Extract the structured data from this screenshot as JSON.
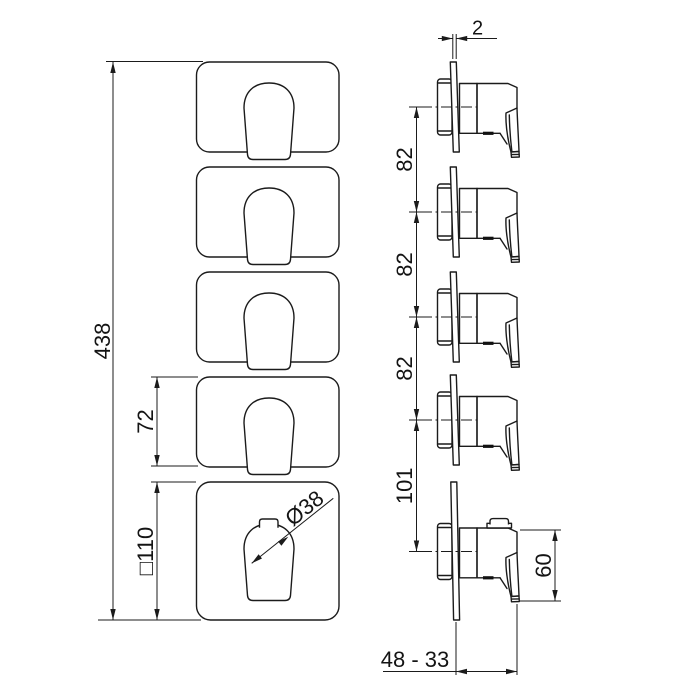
{
  "drawing": {
    "dimensions": {
      "overall_height": "438",
      "small_plate_height": "72",
      "plate_size": "□110",
      "handle_diameter": "Ø38",
      "plate_thickness": "2",
      "spacing_1": "82",
      "spacing_2": "82",
      "spacing_3": "82",
      "spacing_4": "101",
      "handle_height": "60",
      "mounting_depth_range": "48 - 33"
    }
  }
}
